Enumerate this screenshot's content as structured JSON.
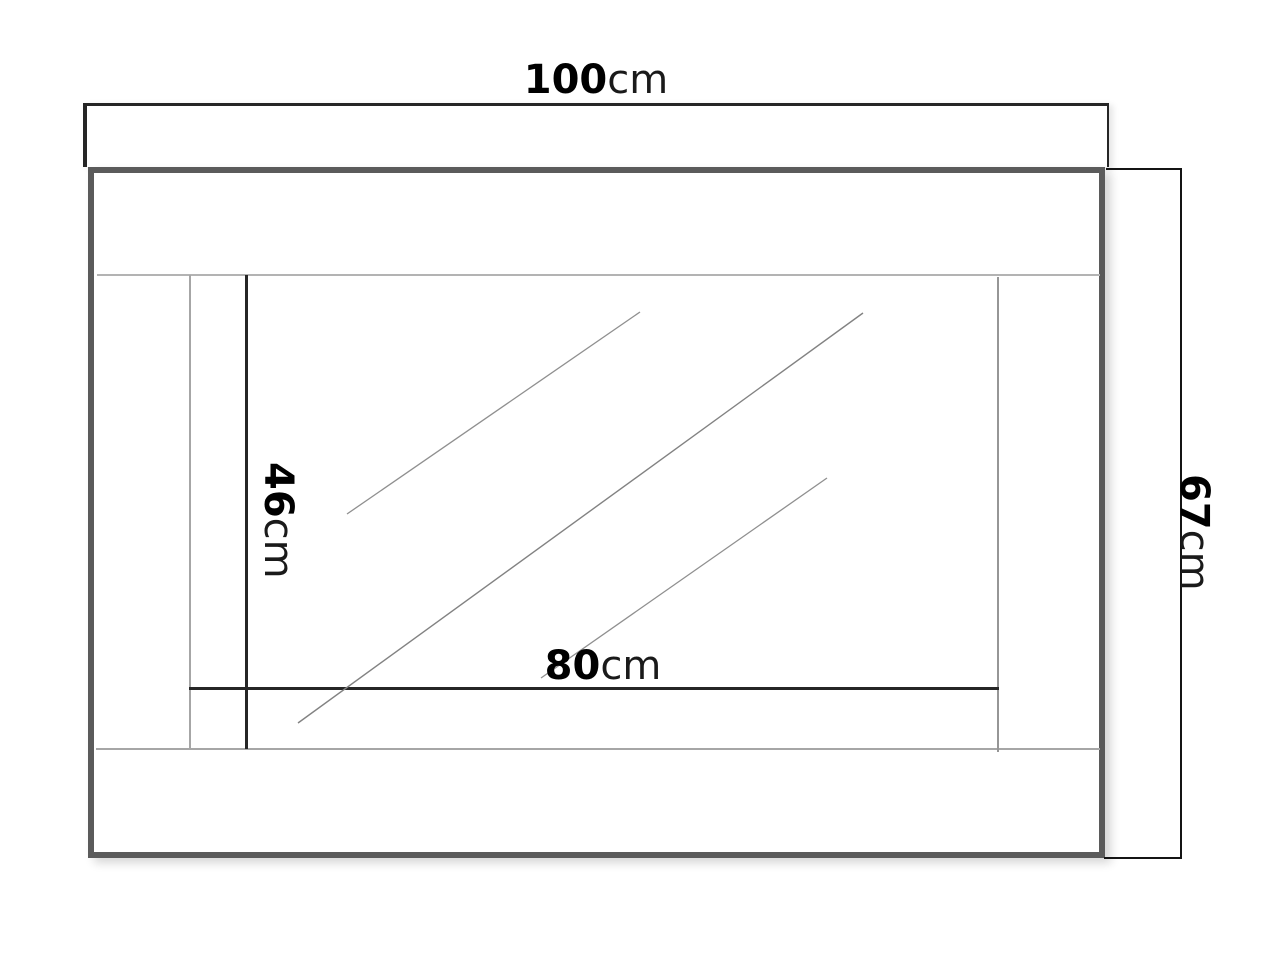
{
  "diagram": {
    "dimensions": {
      "overall_width": {
        "value": "100",
        "unit": "cm"
      },
      "overall_height": {
        "value": "67",
        "unit": "cm"
      },
      "mirror_width": {
        "value": "80",
        "unit": "cm"
      },
      "mirror_height": {
        "value": "46",
        "unit": "cm"
      }
    },
    "colors": {
      "background": "#ffffff",
      "frame_border": "#5b5b5b",
      "shelf_border": "#262626",
      "dimension_line": "#262626",
      "bracket_line": "#141414",
      "faint_seam_line": "#b3b3b3",
      "reflection_line": "#8f8f8f",
      "text": "#000000"
    }
  }
}
